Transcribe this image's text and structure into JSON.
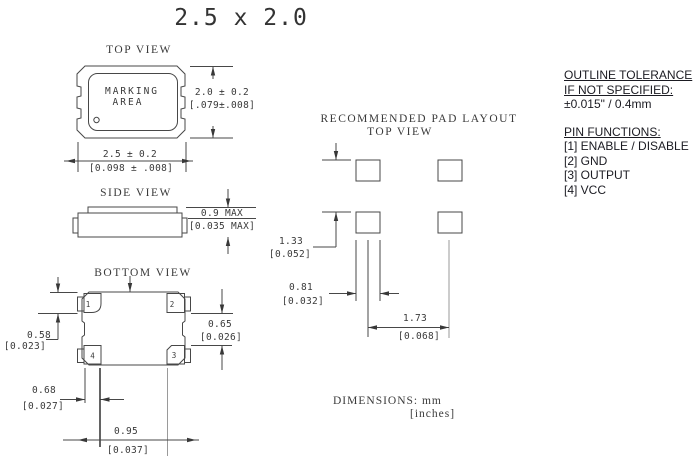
{
  "title": "2.5 x 2.0",
  "views": {
    "top": {
      "label": "TOP VIEW",
      "marking_line1": "MARKING",
      "marking_line2": "AREA",
      "dim_height_mm": "2.0 ± 0.2",
      "dim_height_in": "[.079±.008]",
      "dim_width_mm": "2.5 ± 0.2",
      "dim_width_in": "[0.098 ± .008]"
    },
    "side": {
      "label": "SIDE VIEW",
      "dim_mm": "0.9 MAX",
      "dim_in": "[0.035 MAX]"
    },
    "bottom": {
      "label": "BOTTOM VIEW",
      "pads": [
        "1",
        "2",
        "3",
        "4"
      ],
      "dim_pad_height_mm": "0.58",
      "dim_pad_height_in": "[0.023]",
      "dim_gap_mm": "0.65",
      "dim_gap_in": "[0.026]",
      "dim_offset_mm": "0.68",
      "dim_offset_in": "[0.027]",
      "dim_span_mm": "0.95",
      "dim_span_in": "[0.037]"
    },
    "pad_layout": {
      "title_line1": "RECOMMENDED PAD LAYOUT",
      "title_line2": "TOP VIEW",
      "dim_vertical_mm": "1.33",
      "dim_vertical_in": "[0.052]",
      "dim_pad_width_mm": "0.81",
      "dim_pad_width_in": "[0.032]",
      "dim_horizontal_mm": "1.73",
      "dim_horizontal_in": "[0.068]"
    }
  },
  "notes": {
    "outline_tolerance_line1": "OUTLINE TOLERANCE",
    "outline_tolerance_line2": "IF NOT SPECIFIED:",
    "outline_tolerance_value": "±0.015\" / 0.4mm",
    "pin_functions_title": "PIN FUNCTIONS:",
    "pin_functions": [
      "[1] ENABLE / DISABLE",
      "[2] GND",
      "[3] OUTPUT",
      "[4] VCC"
    ]
  },
  "dimensions_note": {
    "line1": "DIMENSIONS:  mm",
    "line2": "[inches]"
  },
  "colors": {
    "line": "#474747",
    "text": "#3a3a3a",
    "notes_text": "#1b1b22",
    "background": "#ffffff"
  }
}
